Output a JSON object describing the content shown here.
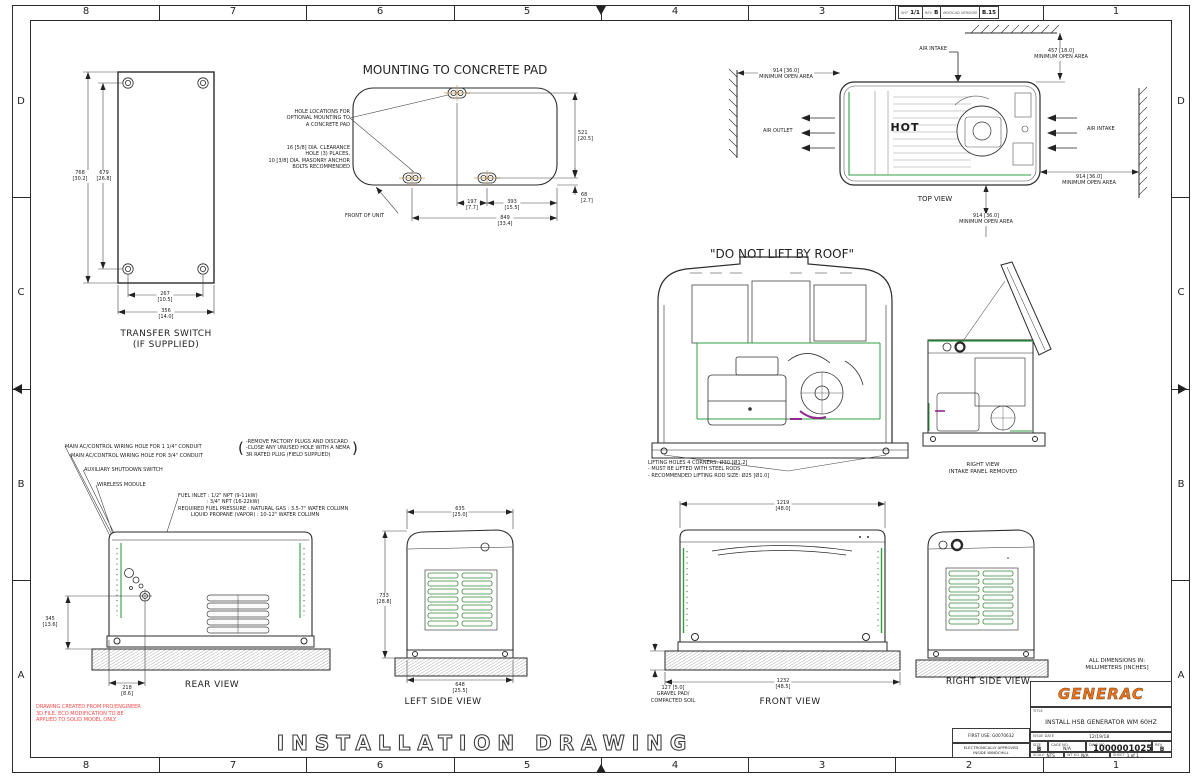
{
  "border": {
    "zone_numbers": [
      "8",
      "7",
      "6",
      "5",
      "4",
      "3",
      "2",
      "1"
    ],
    "zone_letters": [
      "D",
      "C",
      "B",
      "A"
    ],
    "rev_strip": {
      "sht_label": "SHT",
      "sht": "1/1",
      "rev_label": "REV",
      "rev": "B",
      "version_label": "MODCAD VERSION",
      "version": "B.15"
    }
  },
  "transfer_switch": {
    "title": "TRANSFER SWITCH\n(IF SUPPLIED)",
    "dim_768": "768\n[30.2]",
    "dim_679": "679\n[26.8]",
    "dim_267": "267\n[10.5]",
    "dim_356": "356\n[14.0]"
  },
  "concrete_pad": {
    "title": "MOUNTING TO CONCRETE PAD",
    "hole_callout": "HOLE LOCATIONS FOR\nOPTIONAL MOUNTING TO\nA CONCRETE PAD",
    "dia_callout": "16 [5/8] DIA. CLEARANCE\nHOLE (3) PLACES,\n10 [3/8] DIA. MASONRY ANCHOR\nBOLTS RECOMMENDED",
    "front_of_unit": "FRONT OF UNIT",
    "dim_521": "521\n[20.5]",
    "dim_68": "68\n[2.7]",
    "dim_197": "197\n[7.7]",
    "dim_393": "393\n[15.5]",
    "dim_849": "849\n[33.4]"
  },
  "top_view": {
    "label": "TOP VIEW",
    "hot": "HOT",
    "air_intake_top": "AIR INTAKE",
    "air_intake_right": "AIR INTAKE",
    "air_outlet": "AIR OUTLET",
    "min_457": "457 [18.0]\nMINIMUM OPEN AREA",
    "min_914_left": "914 [36.0]\nMINIMUM OPEN AREA",
    "min_914_right": "914 [36.0]\nMINIMUM OPEN AREA",
    "min_914_bottom": "914 [36.0]\nMINIMUM OPEN AREA"
  },
  "lift_view": {
    "title": "\"DO NOT LIFT BY ROOF\"",
    "note": "LIFTING HOLES 4 CORNERS: Ø30 [Ø1.2]\n- MUST BE LIFTED WITH STEEL RODS\n- RECOMMENDED LIFTING ROD SIZE: Ø25 [Ø1.0]"
  },
  "right_view_open": {
    "label": "RIGHT VIEW\nINTAKE PANEL REMOVED"
  },
  "rear_view": {
    "label": "REAR VIEW",
    "callout_conduit_114": "MAIN AC/CONTROL WIRING HOLE FOR 1 1/4\" CONDUIT",
    "callout_conduit_34": "MAIN AC/CONTROL WIRING HOLE FOR 3/4\" CONDUIT",
    "callout_aux": "AUXILIARY SHUTDOWN SWITCH",
    "callout_wireless": "WIRELESS MODULE",
    "fuel_note": "FUEL INLET : 1/2\" NPT (9-11kW)\n                  : 3/4\" NPT (16-22kW)\nREQUIRED FUEL PRESSURE : NATURAL GAS : 3.5-7\" WATER COLUMN\n        LIQUID PROPANE (VAPOR) : 10-12\" WATER COLUMN",
    "plug_note": "-REMOVE FACTORY PLUGS AND DISCARD\n-CLOSE ANY UNUSED HOLE WITH A NEMA\n3R RATED PLUG (FIELD SUPPLIED)",
    "paren_open": "(",
    "paren_close": ")",
    "dim_345": "345\n[13.6]",
    "dim_218": "218\n[8.6]"
  },
  "left_side_view": {
    "label": "LEFT SIDE VIEW",
    "dim_635": "635\n[25.0]",
    "dim_733": "733\n[28.8]",
    "dim_648": "648\n[25.5]"
  },
  "front_view": {
    "label": "FRONT VIEW",
    "dim_1219": "1219\n[48.0]",
    "dim_1232": "1232\n[48.5]",
    "gravel_note": "127 [5.0]\nGRAVEL PAD/\nCOMPACTED SOIL"
  },
  "right_side_view": {
    "label": "RIGHT SIDE VIEW"
  },
  "notes": {
    "all_dims": "ALL DIMENSIONS IN:\nMILLIMETERS [INCHES]",
    "red_note": "DRAWING CREATED FROM PRO/ENGINEER\n3D FILE. ECO MODIFICATION TO BE\nAPPLIED TO SOLID MODEL ONLY.",
    "installation_drawing": "INSTALLATION DRAWING"
  },
  "title_block": {
    "logo": "GENERAC",
    "title_label": "TITLE",
    "title": "INSTALL HSB GENERATOR WM 60HZ",
    "first_use": "FIRST USE: G0070632",
    "approved": "ELECTRONICALLY APPROVED\nINSIDE WINDCHILL",
    "issue_date_label": "ISSUE DATE",
    "issue_date": "12/19/18",
    "size_label": "SIZE",
    "size": "B",
    "cage_label": "CAGE NO.",
    "cage": "N/A",
    "dwg_label": "DWG NO.",
    "dwg": "10000010258",
    "rev_label": "REV",
    "rev": "B",
    "scale_label": "SCALE",
    "scale": "NTS",
    "wt_label": "WT KG",
    "wt": "N/A",
    "sheet_label": "SHEET",
    "sheet": "1 of 1"
  }
}
